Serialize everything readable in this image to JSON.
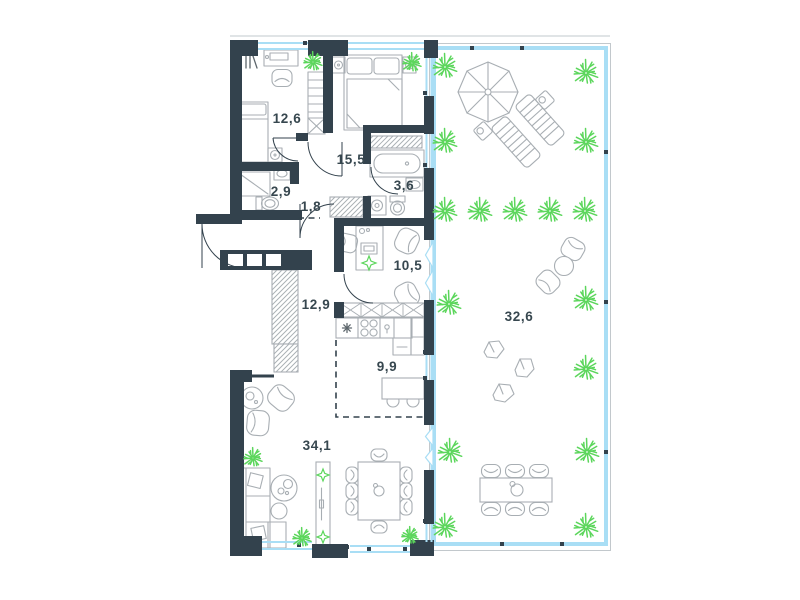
{
  "rooms": [
    {
      "id": "bedroom-1",
      "area_label": "12,6"
    },
    {
      "id": "bedroom-2",
      "area_label": "15,5"
    },
    {
      "id": "shower-room",
      "area_label": "2,9"
    },
    {
      "id": "hall",
      "area_label": "1,8"
    },
    {
      "id": "bathroom",
      "area_label": "3,6"
    },
    {
      "id": "study",
      "area_label": "10,5"
    },
    {
      "id": "hallway",
      "area_label": "12,9"
    },
    {
      "id": "kitchen",
      "area_label": "9,9"
    },
    {
      "id": "living-room",
      "area_label": "34,1"
    },
    {
      "id": "terrace",
      "area_label": "32,6"
    }
  ],
  "colors": {
    "wall": "#33424d",
    "furniture": "#a8aeb3",
    "glazing": "#a9def5",
    "plant": "#5cd65c",
    "label_text": "#37474f"
  }
}
